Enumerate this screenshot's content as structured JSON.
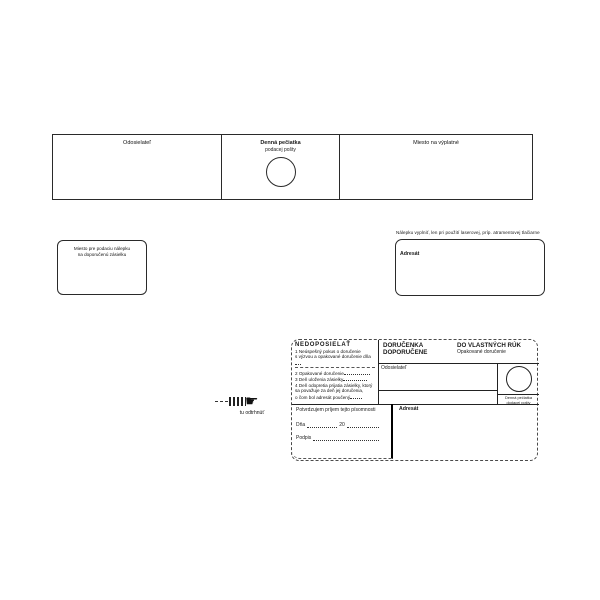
{
  "colors": {
    "ink": "#1a1a1a",
    "border": "#2a2a2a",
    "background": "#ffffff"
  },
  "top_strip": {
    "sender_label": "Odosielateľ",
    "stamp_label_line1": "Denná pečiatka",
    "stamp_label_line2": "podacej pošty",
    "postage_label": "Miesto na výplatné"
  },
  "middle": {
    "sticker_box_line1": "Miesto pre podaciu nálepku",
    "sticker_box_line2": "na doporučenú zásielku",
    "address_caption": "Nálepku vyplniť, len pri použití laserovej, príp. atramentovej tlačiarne",
    "addressee_label": "Adresát"
  },
  "ticket": {
    "nedoposielat": {
      "title": "NEDOPOSIELAŤ",
      "item1_line1": "1 Neúspešný pokus o doručenie",
      "item1_line2": "s výzvou a opakované doručenie dňa",
      "item2": "2 Opakované doručenie",
      "item3": "3 Deň uloženia zásielky",
      "item4_line1": "4 Deň odopretia prijatia zásielky, ktorý",
      "item4_line2": "sa považuje za deň jej doručenia,",
      "item4_line3": "o čom bol adresát poučený"
    },
    "header": {
      "title_line1": "DORUČENKA",
      "title_line2": "DOPORUČENE",
      "right_title": "DO VLASTNÝCH RÚK",
      "right_subtitle": "Opakované doručenie"
    },
    "sender_label": "Odosielateľ",
    "stamp_caption_line1": "Denná pečiatka",
    "stamp_caption_line2": "dodacej pošty",
    "confirm": {
      "statement": "Potvrdzujem príjem tejto písomnosti",
      "date_label": "Dňa",
      "year_prefix": "20",
      "signature_label": "Podpis"
    },
    "addressee_label": "Adresát",
    "tear": {
      "hand_icon": "☛",
      "label": "tu odtrhnúť"
    }
  }
}
